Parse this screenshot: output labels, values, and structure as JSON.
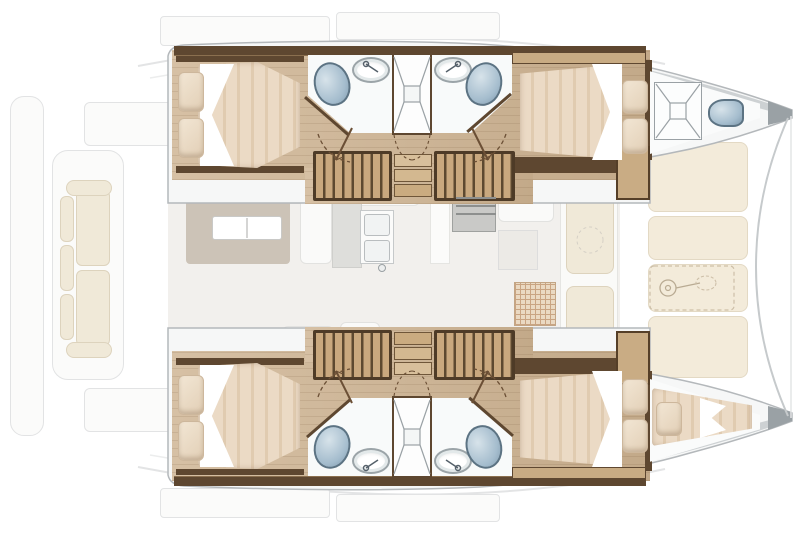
{
  "diagram": {
    "type": "floorplan",
    "subject": "sailing-catamaran-interior-layout",
    "view": "overhead",
    "bow_direction": "right",
    "highlighted_deck": "lower-deck-hull-cabins",
    "faded_deck": "main-deck-saloon-cockpit-foredeck"
  },
  "rooms": {
    "port_aft_cabin": "Port aft double cabin",
    "port_aft_bathroom": "Port aft bathroom with toilet and washbasin",
    "port_shower": "Port central shower",
    "port_fwd_bathroom": "Port forward bathroom with toilet and washbasin",
    "port_fwd_cabin": "Port forward double cabin",
    "port_forepeak": "Port forepeak with deck hatch and sea toilet",
    "port_companionway": "Port companionway steps",
    "stbd_aft_cabin": "Starboard aft double cabin",
    "stbd_aft_bathroom": "Starboard aft bathroom with toilet and washbasin",
    "stbd_shower": "Starboard central shower",
    "stbd_fwd_bathroom": "Starboard forward bathroom with toilet and washbasin",
    "stbd_fwd_cabin": "Starboard forward double cabin",
    "stbd_forepeak": "Starboard forepeak berth",
    "stbd_companionway": "Starboard companionway steps",
    "saloon": "Saloon with table and galley (main deck, faded)",
    "cockpit": "Aft cockpit sofa (faded)",
    "foredeck": "Foredeck sunpads with anchor windlass (faded)"
  },
  "fixtures": [
    "double-bed",
    "pillow",
    "toilet",
    "washbasin",
    "shower-tray",
    "companionway-steps",
    "deck-hatch",
    "anchor-windlass",
    "galley-sink",
    "stove",
    "saloon-table",
    "cockpit-sofa",
    "sunpad",
    "door-swing"
  ],
  "colors": {
    "wood_floor": "#cdb290",
    "wood_dark": "#5e4730",
    "wood_trim": "#8a6d4c",
    "stair_tread": "#c9a87e",
    "stair_rib": "#5d4930",
    "step_wood": "#d8bf9b",
    "mattress_light": "#ebdac5",
    "mattress_dark": "#e0cbb0",
    "pillow_light": "#f2e6d4",
    "pillow_dark": "#e2cfb6",
    "sheet": "#ffffff",
    "bath_white": "#f8fafa",
    "toilet_blue": "#a4bccd",
    "toilet_blue_dark": "#5c7383",
    "hull_white": "#f6f7f7",
    "hull_line": "#b4b8bb",
    "deck_grey": "#cdd1d3",
    "bow_cap": "#9aa1a5",
    "faded_line": "#e2e3e4",
    "faded_fill": "#f2f0ed",
    "bench_white": "#fafaf9",
    "cushion_cream": "#f0e9d8",
    "rug_taupe": "#ccc3b7",
    "foredeck_cream": "#f3ebda",
    "grid_tan": "#c9a482",
    "door_line": "#6b4f35"
  }
}
